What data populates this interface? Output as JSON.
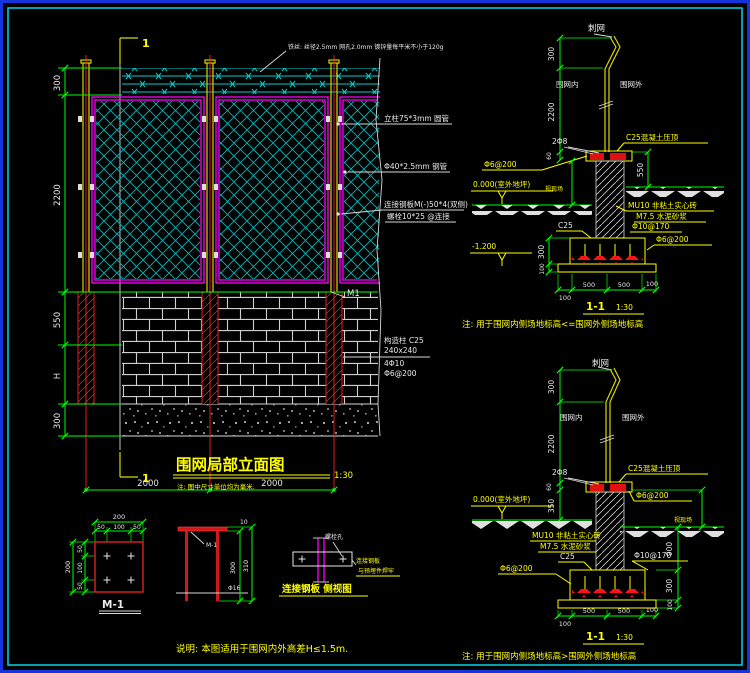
{
  "elevation": {
    "section_mark": "1",
    "wire_note": "铁丝: 丝径2.5mm 网孔2.0mm 镀锌量每平米不小于120g",
    "post_label": "立柱75*3mm 圆管",
    "frame_label": "Φ40*2.5mm 钢管",
    "plate_label_1": "连接钢板M(-)50*4(双侧)",
    "plate_label_2": "螺栓10*25 @连接",
    "m1": "M1",
    "column_lines": [
      "构造柱 C25",
      "240x240",
      "4Φ10",
      "Φ6@200"
    ],
    "dims_left": [
      "300",
      "2200",
      "550",
      "H",
      "300"
    ],
    "dims_bottom": [
      "2000",
      "2000"
    ],
    "title": "围网局部立面图",
    "scale": "1:30",
    "title_note": "注: 图中尺寸单位均为毫米."
  },
  "section_top": {
    "barbed": "刺网",
    "inside": "围网内",
    "outside": "围网外",
    "rebar": "2Φ8",
    "coping": "C25混凝土压顶",
    "coping_stirrup": "Φ6@200",
    "level": "0.000(室外地坪)",
    "site_dim": "视现场",
    "masonry": [
      "MU10 非粘土实心砖",
      "M7.5 水泥砂浆",
      "Φ10@170"
    ],
    "footing_grade": "C25",
    "footing_level": "-1.200",
    "footing_stirrup": "Φ6@200",
    "dims": {
      "top": "300",
      "post": "2200",
      "coping_t": "60",
      "right": "550",
      "f_h": "300",
      "f_t": "100",
      "b": [
        "100",
        "500",
        "500",
        "100"
      ]
    },
    "title": "1-1",
    "scale": "1:30",
    "note": "注: 用于围网内侧场地标高<=围网外侧场地标高"
  },
  "section_bottom": {
    "barbed": "刺网",
    "inside": "围网内",
    "outside": "围网外",
    "rebar": "2Φ8",
    "coping": "C25混凝土压顶",
    "coping_stirrup": "Φ6@200",
    "level": "0.000(室外地坪)",
    "site_dim": "视现场",
    "masonry": [
      "MU10 非粘土实心砖",
      "M7.5 水泥砂浆"
    ],
    "footing_grade": "C25",
    "footing_bar": "Φ10@170",
    "footing_stirrup": "Φ6@200",
    "dims": {
      "top": "300",
      "post": "2200",
      "coping_t": "60",
      "inner": "350",
      "outer": "900",
      "f_h": "300",
      "f_t": "100",
      "b": [
        "100",
        "500",
        "500",
        "100"
      ]
    },
    "title": "1-1",
    "scale": "1:30",
    "note": "注: 用于围网内侧场地标高>围网外侧场地标高"
  },
  "detail_m1": {
    "title": "M-1",
    "dims": {
      "top_total": "200",
      "top": [
        "50",
        "100",
        "50"
      ],
      "left_total": "200",
      "left": [
        "50",
        "100",
        "50"
      ]
    }
  },
  "detail_post": {
    "plate_ref": "M-1",
    "anchor": "Φ16",
    "dims": {
      "t": "10",
      "inner": "300",
      "outer": "310"
    }
  },
  "detail_plate": {
    "hole": "螺栓孔",
    "weld_1": "连接钢板",
    "weld_2": "与预埋件焊牢",
    "title": "连接钢板 侧视图"
  },
  "footer_note": "说明: 本图适用于围网内外高差H≤1.5m."
}
